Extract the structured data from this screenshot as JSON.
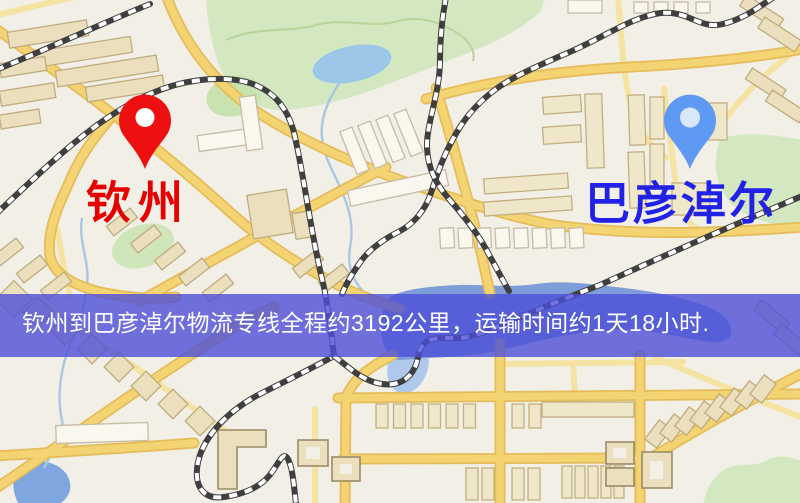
{
  "banner": {
    "text": "钦州到巴彦淖尔物流专线全程约3192公里，运输时间约1天18小时.",
    "background_color": "#4c4fd7",
    "text_color": "#ffffff",
    "route": {
      "origin": "钦州",
      "destination": "巴彦淖尔",
      "service_type": "物流专线",
      "distance": "全程约3192公里",
      "transport_time": "运输时间约1天18小时"
    }
  },
  "map": {
    "origin_marker": {
      "label": "钦州",
      "pin_color": "#ee1010",
      "label_color": "#e60000"
    },
    "destination_marker": {
      "label": "巴彦淖尔",
      "pin_color": "#5e9af4",
      "label_color": "#2222e6"
    },
    "theme": {
      "background": "#f2efe6",
      "road_major": "#f4d373",
      "road_minor": "#f5e3a2",
      "railway": "#3f3f3f",
      "water": "#7e9dd9",
      "lake": "#9cc7e9",
      "park": "#d3e7c0",
      "building": "#ebdfbe"
    }
  }
}
